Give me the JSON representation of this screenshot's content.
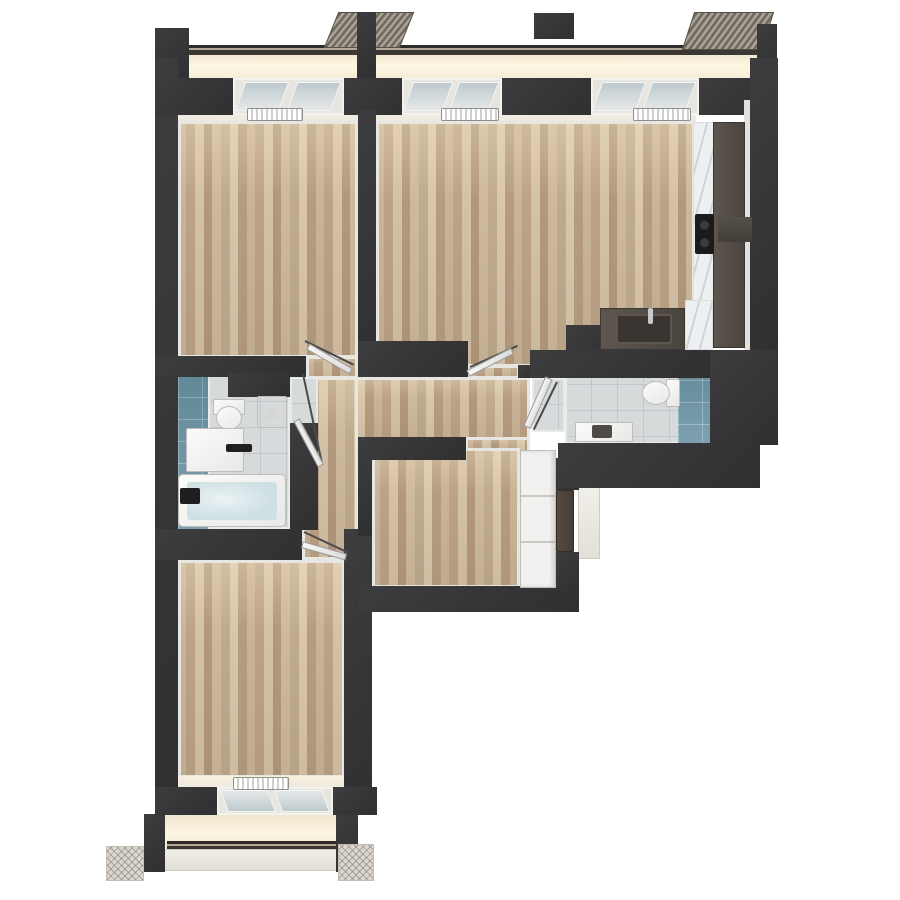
{
  "scene": {
    "type": "3d-floor-plan-render",
    "view": "top-down",
    "background": "#ffffff",
    "text_visible": "none"
  },
  "palette": {
    "wall": "#3a3a3c",
    "wood_floor": "#c3ae91",
    "tile_floor": "#d6dadb",
    "blue_tile": "#6e97a7",
    "counter_dark": "#4f4943",
    "marble": "#edeff1",
    "bath_water": "#cfe0e4",
    "facade_cream": "#f5ecd6",
    "canopy_hatch": "#968f83",
    "fixture_white": "#f4f4f2",
    "entrance_door": "#4c433b"
  },
  "rooms": {
    "bedroom_top_left": {
      "label": "Bedroom top left",
      "floor": "wood parquet"
    },
    "living_kitchen": {
      "label": "Living room with kitchen",
      "floor": "wood parquet"
    },
    "bathroom_left": {
      "label": "Bathroom with bathtub",
      "floor": "grey tile with blue accent wall"
    },
    "bathroom_right": {
      "label": "Bathroom with toilet",
      "floor": "grey tile with blue accent wall"
    },
    "hallway": {
      "label": "Hallway",
      "floor": "wood parquet"
    },
    "entry_room": {
      "label": "Entry room with wardrobe",
      "floor": "wood parquet"
    },
    "bedroom_bottom_left": {
      "label": "Bedroom bottom left",
      "floor": "wood parquet"
    }
  },
  "fixtures": {
    "toilet_left": "Wall-hung toilet",
    "toilet_right": "Toilet with cistern",
    "washing_machine": "Washing machine",
    "vanity_left": "Washbasin vanity",
    "vanity_right": "Washbasin vanity",
    "bathtub": "Bathtub filled with water",
    "kitchen_counter": "L-shaped kitchen counter",
    "kitchen_sink": "Kitchen sink with faucet",
    "cooktop": "Cooktop with burners",
    "wardrobe": "Built-in wardrobe",
    "entrance_door": "Apartment entrance door",
    "radiators": "Radiators under windows"
  },
  "openings": {
    "windows_top": 3,
    "windows_bottom": 1,
    "interior_doors": 5,
    "entrance_doors": 1
  },
  "exterior": {
    "balcony_rails": 2,
    "canopies": 3,
    "concrete_pads": 2
  }
}
